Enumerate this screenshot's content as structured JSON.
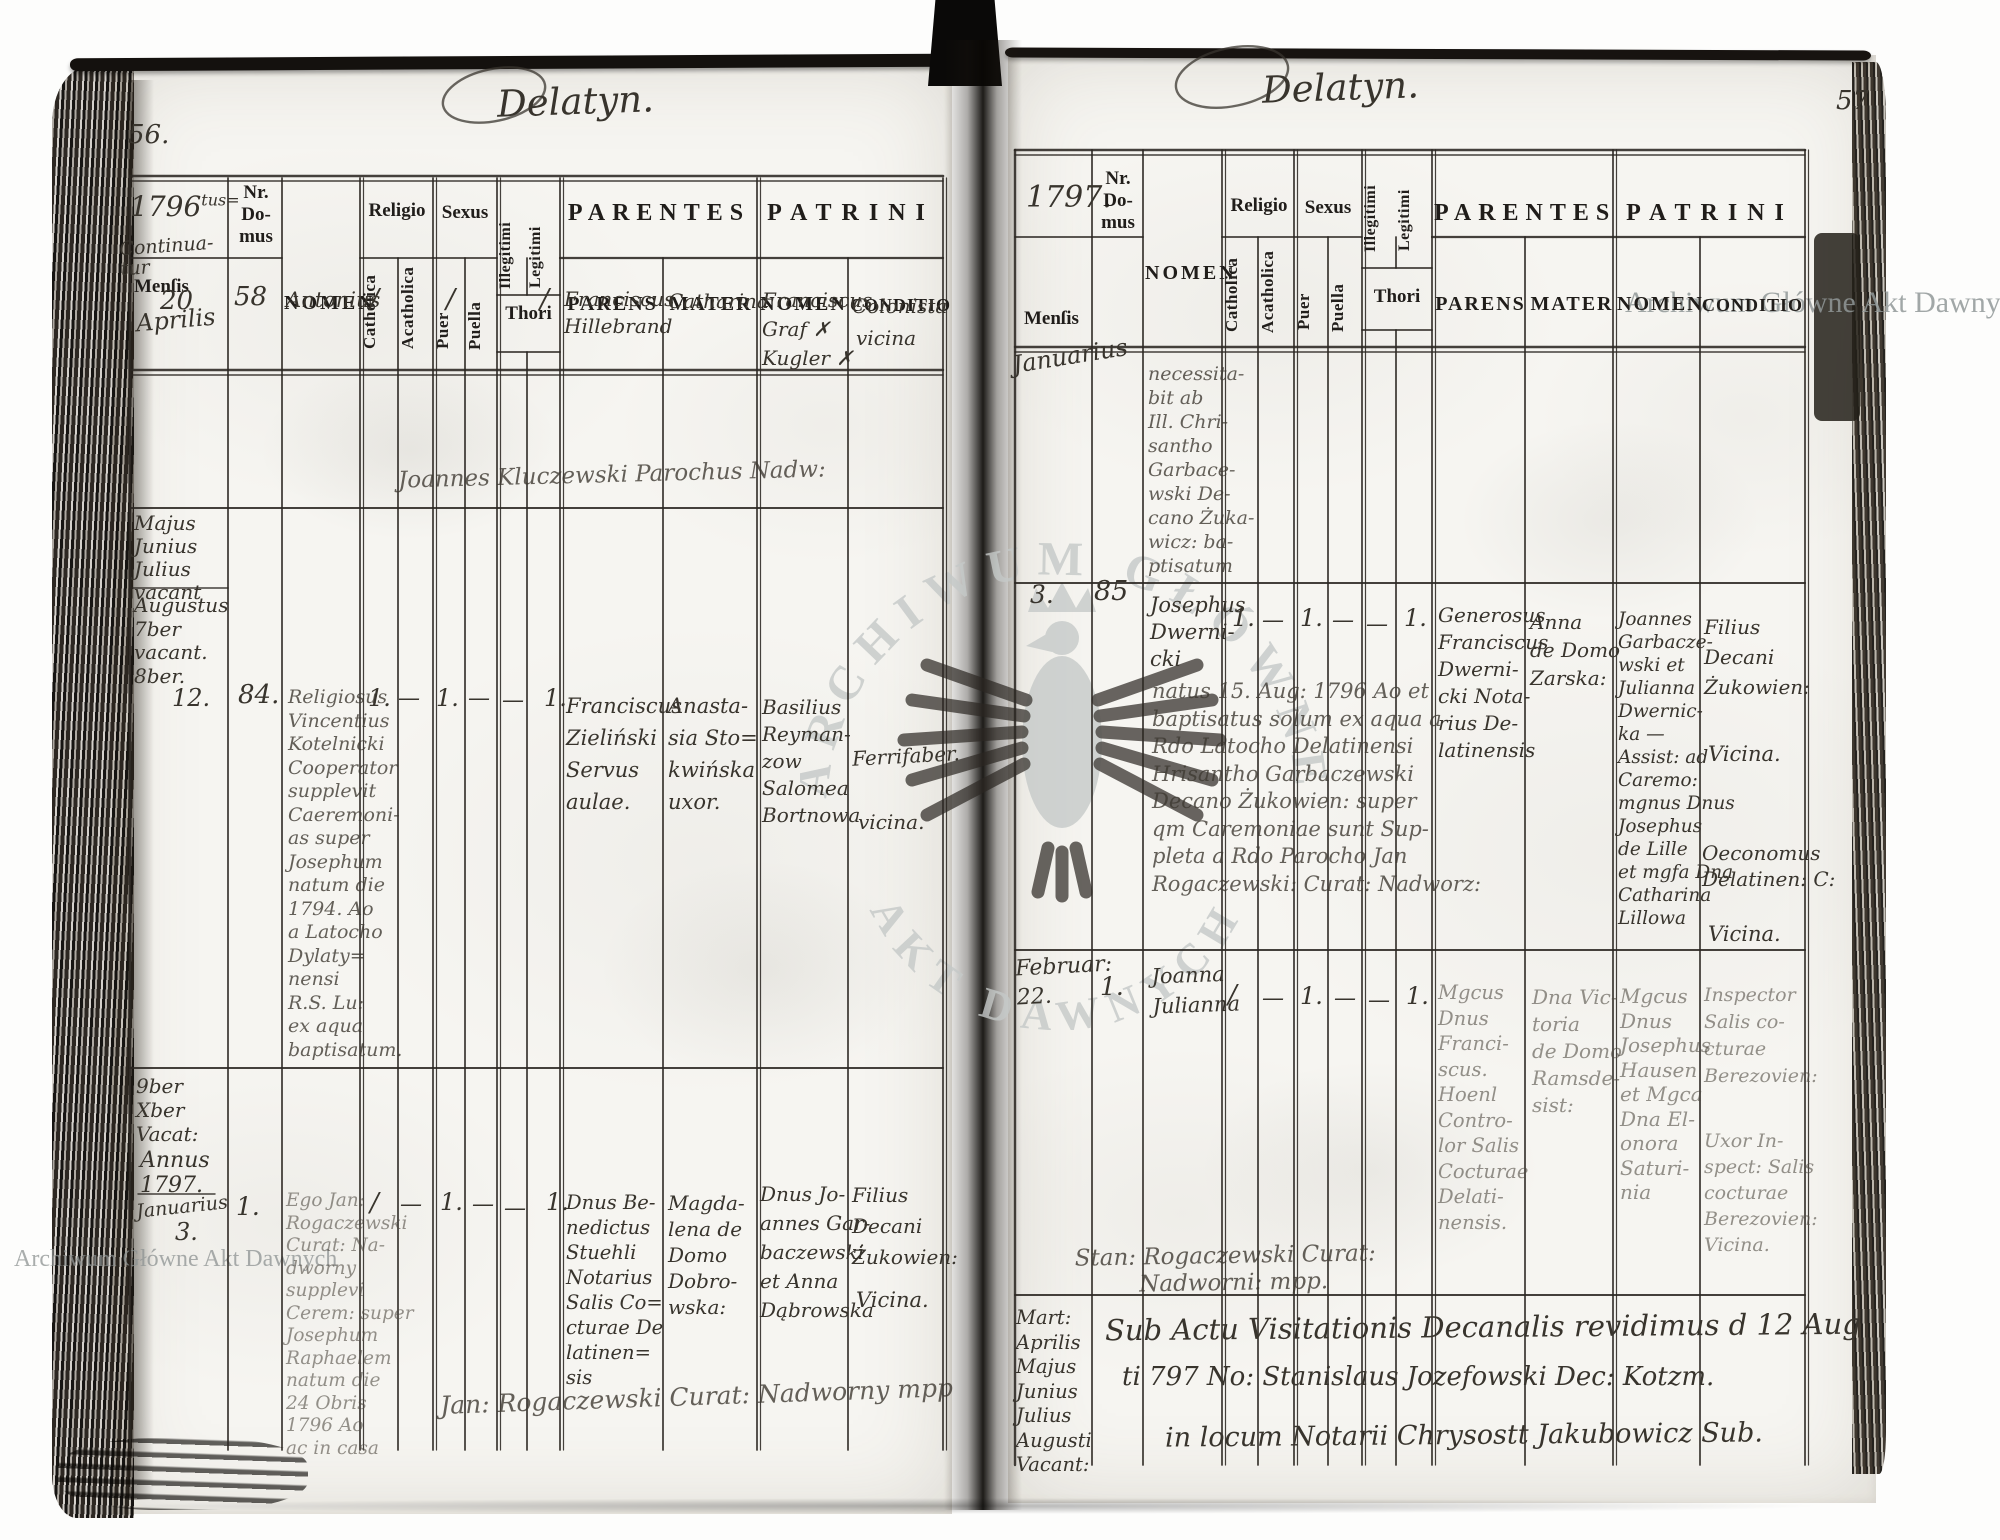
{
  "watermarks": {
    "horizontal_text": "Archiwum Główne Akt Dawnych",
    "seal_top": "ARCHIWUM GŁÓWNE",
    "seal_bottom": "AKT DAWNYCH",
    "seal_icon": "eagle-emblem"
  },
  "column_headers": {
    "nr_lines": [
      "Nr.",
      "Do-",
      "mus"
    ],
    "nomen": "NOMEN",
    "religio": "Religio",
    "sexus": "Sexus",
    "catholica": "Catholica",
    "acatholica": "Acatholica",
    "puer": "Puer",
    "puella": "Puella",
    "illegitimi": "Illegitimi",
    "legitimi": "Legitimi",
    "thori": "Thori",
    "parentes": "PARENTES",
    "parens": "PARENS",
    "mater": "MATER",
    "patrini": "PATRINI",
    "patrini_nomen": "NOMEN",
    "conditio": "CONDITIO",
    "mensis": "Menſis"
  },
  "left_page": {
    "page_number": "56.",
    "title": "Delatyn.",
    "year": "1796",
    "year_sup": "tus=",
    "continuatur": [
      "Continua-",
      "tur"
    ],
    "month": "Aprilis",
    "entry1": {
      "dies": "20",
      "nr": "58",
      "nomen": "Antonius",
      "catholica": "/",
      "puer": "/",
      "legitimi": "/",
      "parens": [
        "Franciscus",
        "Hillebrand"
      ],
      "mater": [
        "Catharina"
      ],
      "patrini_nomen": [
        "Franciscus",
        "Graf ✗",
        "Kugler ✗"
      ],
      "conditio": [
        "Colonista"
      ],
      "conditio_b": "vicina",
      "officiant": "Joannes Kluczewski Parochus Nadw:"
    },
    "margin_block1": [
      "Majus",
      "Junius",
      "Julius",
      "vacant"
    ],
    "margin_block2": [
      "Augustus",
      "7ber",
      "vacant.",
      "8ber."
    ],
    "entry2": {
      "dies": "12.",
      "nr": "84.",
      "nomen": [
        "Religiosus",
        "Vincentius",
        "Kotelnicki",
        "Cooperator",
        "supplevit",
        "Caeremoni-",
        "as super",
        "Josephum",
        "natum die",
        "1794. Ao",
        "a Latocho",
        "Dylaty=",
        "nensi",
        "R.S. Lu:",
        "ex aqua",
        "baptisatum."
      ],
      "catholica": "1.",
      "acatholica": "—",
      "puer": "1.",
      "puella": "—",
      "illegitimi": "—",
      "legitimi": "1.",
      "parens": [
        "Franciscus",
        "Zieliński",
        "Servus",
        "aulae."
      ],
      "mater": [
        "Anasta-",
        "sia Sto=",
        "kwińska",
        "uxor."
      ],
      "patrini_nomen": [
        "Basilius",
        "Reyman-",
        "zow",
        "Salomea",
        "Bortnowa"
      ],
      "conditio": "Ferrifaber.",
      "conditio_b": "vicina."
    },
    "margin_block3": [
      "9ber",
      "Xber",
      "Vacat:"
    ],
    "margin_block4": [
      "Annus",
      "1797."
    ],
    "margin_month": "Januarius",
    "entry3": {
      "dies": "3.",
      "nr": "1.",
      "nomen": [
        "Ego Jan:",
        "Rogaczewski",
        "Curat: Na-",
        "dworny",
        "supplevi",
        "Cerem: super",
        "Josephum",
        "Raphaelem",
        "natum die",
        "24 Obris",
        "1796 Ao",
        "ac in casa"
      ],
      "catholica": "/",
      "acatholica": "—",
      "puer": "1.",
      "puella": "—",
      "illegitimi": "—",
      "legitimi": "1.",
      "parens": [
        "Dnus Be-",
        "nedictus",
        "Stuehli",
        "Notarius",
        "Salis Co=",
        "cturae De",
        "latinen=",
        "sis"
      ],
      "mater": [
        "Magda-",
        "lena de",
        "Domo",
        "Dobro-",
        "wska:"
      ],
      "patrini_nomen": [
        "Dnus Jo-",
        "annes Gar-",
        "baczewski",
        "et Anna",
        "Dąbrowska"
      ],
      "conditio": [
        "Filius",
        "Decani",
        "Żukowien:"
      ],
      "conditio_b": "Vicina.",
      "signature": "Jan: Rogaczewski Curat: Nadworny mpp"
    }
  },
  "right_page": {
    "page_number": "57.",
    "title": "Delatyn.",
    "year": "1797.",
    "month": "Januarius",
    "entry0": {
      "nomen": [
        "necessita-",
        "bit ab",
        "Ill. Chri-",
        "santho",
        "Garbace-",
        "wski De-",
        "cano Żuka-",
        "wicz: ba-",
        "ptisatum"
      ]
    },
    "entry1": {
      "dies": "3.",
      "nr": "85",
      "nomen": [
        "Josephus",
        "Dwerni-",
        "cki"
      ],
      "nomen_wide": [
        "natus 15. Aug: 1796 Ao et",
        "baptisatus solum ex aqua a",
        "Rdo Latocho Delatinensi",
        "Hrisantho Garbaczewski",
        "Decano Żukowien: super",
        "qm Caremoniae sunt Sup-",
        "pleta a Rdo Parocho Jan",
        "Rogaczewski: Curat: Nadworz:"
      ],
      "catholica": "1.",
      "acatholica": "—",
      "puer": "1.",
      "puella": "—",
      "illegitimi": "—",
      "legitimi": "1.",
      "parens": [
        "Generosus",
        "Franciscus",
        "Dwerni-",
        "cki Nota-",
        "rius De-",
        "latinensis"
      ],
      "mater": [
        "Anna",
        "de Domo",
        "Zarska:"
      ],
      "patrini_nomen": [
        "Joannes",
        "Garbacze-",
        "wski et",
        "Julianna",
        "Dwernic-",
        "ka —",
        "Assist: ad",
        "Caremo:",
        "mgnus Dnus",
        "Josephus",
        "de Lille",
        "et mgfa Dna",
        "Catharina",
        "Lillowa"
      ],
      "conditio": [
        "Filius",
        "Decani",
        "Żukowien:"
      ],
      "conditio_b": "Vicina.",
      "conditio_c": [
        "Oeconomus",
        "Delatinen: C:"
      ],
      "conditio_d": "Vicina."
    },
    "entry2": {
      "dies": [
        "Februar:",
        "22."
      ],
      "nr": "1.",
      "nomen": [
        "Joanna",
        "Julianna"
      ],
      "catholica": "/",
      "acatholica": "—",
      "puer": "1.",
      "puella": "—",
      "illegitimi": "—",
      "legitimi": "1.",
      "parens": [
        "Mgcus",
        "Dnus",
        "Franci-",
        "scus.",
        "Hoenl",
        "Contro-",
        "lor Salis",
        "Cocturae",
        "Delati-",
        "nensis."
      ],
      "mater": [
        "Dna Vic-",
        "toria",
        "de Domo",
        "Ramsde-",
        "sist:"
      ],
      "patrini_nomen": [
        "Mgcus",
        "Dnus",
        "Josephus",
        "Hausen",
        "et Mgca",
        "Dna El-",
        "onora",
        "Saturi-",
        "nia"
      ],
      "conditio": [
        "Inspector",
        "Salis co-",
        "cturae",
        "Berezovien:"
      ],
      "conditio_b": [
        "Uxor In-",
        "spect: Salis",
        "cocturae",
        "Berezovien:",
        "Vicina."
      ],
      "signature": [
        "Stan: Rogaczewski Curat:",
        "Nadworni: mpp."
      ]
    },
    "visitation_months": [
      "Mart:",
      "Aprilis",
      "Majus",
      "Junius",
      "Julius",
      "Augusti",
      "Vacant:"
    ],
    "visitation_note": [
      "Sub Actu Visitationis Decanalis revidimus d 12 Aug",
      "ti 797 No: Stanislaus Jozefowski Dec: Kotzm.",
      "in locum Notarii Chrysostt Jakubowicz Sub."
    ]
  }
}
